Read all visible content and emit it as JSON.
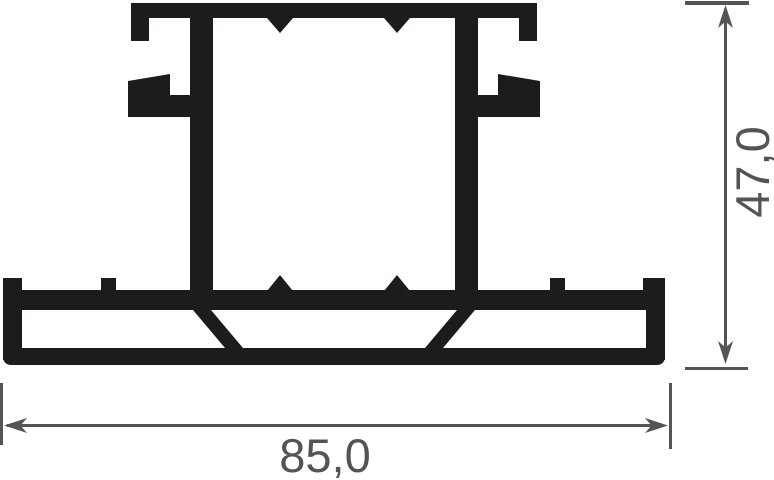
{
  "drawing": {
    "type": "technical-cross-section",
    "subject": "extruded-profile",
    "background_color": "#ffffff",
    "profile_color": "#1d1b1c",
    "dimension_color": "#545456",
    "dimensions": {
      "height": {
        "label": "47,0",
        "orientation": "vertical",
        "position": "right"
      },
      "width": {
        "label": "85,0",
        "orientation": "horizontal",
        "position": "bottom"
      }
    }
  }
}
